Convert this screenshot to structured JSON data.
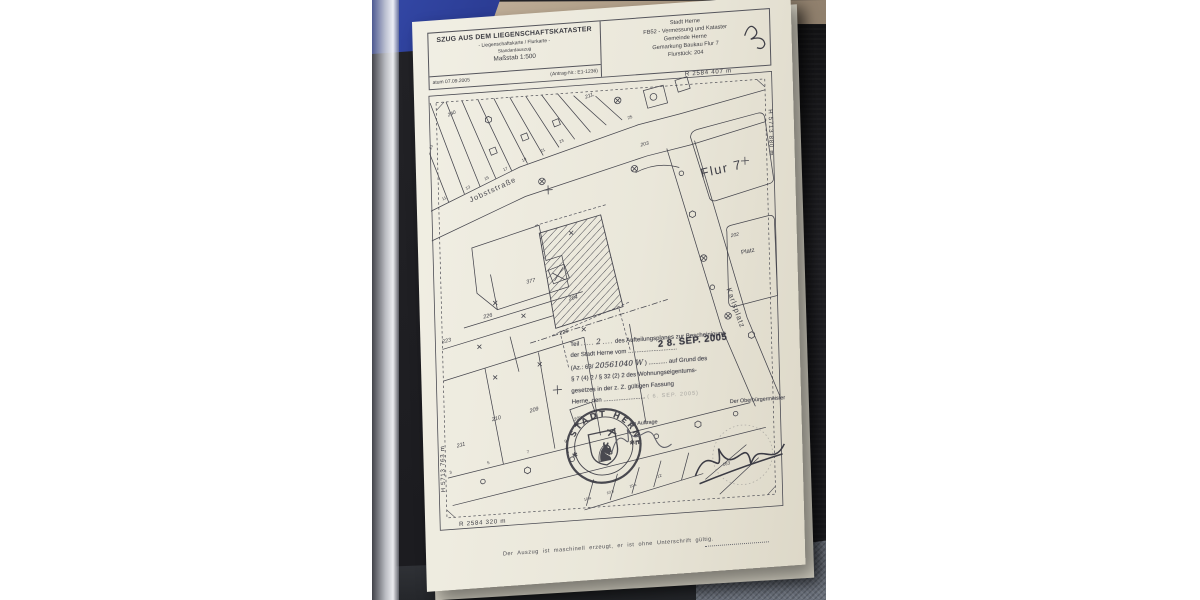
{
  "photo": {
    "colors": {
      "background": "#232327",
      "blue_fabric": "#2c3d95",
      "floor": "#ab9983",
      "carpet": "#6b717c",
      "paper": "#eae7da",
      "ink": "#3c3c42",
      "stamp_ink": "#45454e"
    }
  },
  "document": {
    "header": {
      "title": "SZUG AUS DEM LIEGENSCHAFTSKATASTER",
      "subtitle": "- Liegenschaftskarte / Flurkarte -",
      "subtitle2": "Standardauszug",
      "scale": "Maßstab 1:500",
      "date_line": "atum 07.09.2005",
      "request_no": "(Antrag-Nr.: E1-1236)",
      "office": [
        "Stadt Herne",
        "FB52 - Vermessung und Kataster",
        "Gemeinde Herne",
        "Gemarkung Baukau Flur 7",
        "Flurstück: 204"
      ],
      "handwritten_mark": "20"
    },
    "coordinates": {
      "top_right": "R 2584 407 m",
      "right": "H 5713 880 m",
      "left": "H 5713 763 m",
      "bottom_left": "R 2584 320 m"
    },
    "map_labels": [
      {
        "text": "240",
        "x": 20,
        "y": 34,
        "rot": -20,
        "size": 5,
        "cls": "it"
      },
      {
        "text": "211,",
        "x": 158,
        "y": 26,
        "rot": -18,
        "size": 5.2,
        "cls": "it"
      },
      {
        "text": "25",
        "x": 200,
        "y": 50,
        "rot": -18,
        "size": 4.4,
        "cls": ""
      },
      {
        "text": "23",
        "x": 2,
        "y": 66,
        "rot": -65,
        "size": 4,
        "cls": ""
      },
      {
        "text": "11",
        "x": 12,
        "y": 118,
        "rot": -22,
        "size": 4.2,
        "cls": ""
      },
      {
        "text": "13",
        "x": 36,
        "y": 109,
        "rot": -22,
        "size": 4.2,
        "cls": ""
      },
      {
        "text": "15",
        "x": 55,
        "y": 101,
        "rot": -22,
        "size": 4.2,
        "cls": ""
      },
      {
        "text": "17",
        "x": 74,
        "y": 93,
        "rot": -22,
        "size": 4.2,
        "cls": ""
      },
      {
        "text": "19",
        "x": 93,
        "y": 85,
        "rot": -22,
        "size": 4.2,
        "cls": ""
      },
      {
        "text": "21",
        "x": 112,
        "y": 77,
        "rot": -22,
        "size": 4.2,
        "cls": ""
      },
      {
        "text": "23",
        "x": 131,
        "y": 69,
        "rot": -22,
        "size": 4.2,
        "cls": ""
      },
      {
        "text": "Jobststraße",
        "x": 40,
        "y": 122,
        "rot": -21,
        "size": 7.5,
        "cls": "street"
      },
      {
        "text": "Flur 7",
        "x": 272,
        "y": 114,
        "rot": -9,
        "size": 13,
        "cls": "flur"
      },
      {
        "text": "203",
        "x": 212,
        "y": 78,
        "rot": -10,
        "size": 5,
        "cls": "it"
      },
      {
        "text": "202",
        "x": 300,
        "y": 176,
        "rot": -8,
        "size": 5,
        "cls": "it"
      },
      {
        "text": "Platz",
        "x": 310,
        "y": 194,
        "rot": -8,
        "size": 6.2,
        "cls": ""
      },
      {
        "text": "Karlsplatz",
        "x": 294,
        "y": 228,
        "rot": 72,
        "size": 7.5,
        "cls": "street"
      },
      {
        "text": "377",
        "x": 94,
        "y": 208,
        "rot": -10,
        "size": 5.5,
        "cls": "it"
      },
      {
        "text": "204",
        "x": 136,
        "y": 228,
        "rot": -10,
        "size": 5.5,
        "cls": "it"
      },
      {
        "text": "226",
        "x": 50,
        "y": 240,
        "rot": -10,
        "size": 5.5,
        "cls": "it"
      },
      {
        "text": "223",
        "x": 8,
        "y": 262,
        "rot": -10,
        "size": 5.5,
        "cls": "it"
      },
      {
        "text": "225",
        "x": 126,
        "y": 262,
        "rot": -13,
        "size": 5.5,
        "cls": "it"
      },
      {
        "text": "210",
        "x": 56,
        "y": 344,
        "rot": -12,
        "size": 5.5,
        "cls": "it"
      },
      {
        "text": "211",
        "x": 20,
        "y": 368,
        "rot": -12,
        "size": 5.5,
        "cls": "it"
      },
      {
        "text": "209",
        "x": 94,
        "y": 338,
        "rot": -12,
        "size": 5.5,
        "cls": "it"
      },
      {
        "text": "208",
        "x": 138,
        "y": 350,
        "rot": -12,
        "size": 5,
        "cls": "it"
      },
      {
        "text": "4",
        "x": 130,
        "y": 382,
        "rot": -12,
        "size": 4.2,
        "cls": ""
      },
      {
        "text": "3",
        "x": 12,
        "y": 394,
        "rot": -12,
        "size": 4.2,
        "cls": ""
      },
      {
        "text": "5",
        "x": 50,
        "y": 387,
        "rot": -12,
        "size": 4.2,
        "cls": ""
      },
      {
        "text": "7",
        "x": 90,
        "y": 379,
        "rot": -12,
        "size": 4.2,
        "cls": ""
      },
      {
        "text": "9",
        "x": 128,
        "y": 371,
        "rot": -12,
        "size": 4.2,
        "cls": ""
      },
      {
        "text": "10 a",
        "x": 146,
        "y": 431,
        "rot": -13,
        "size": 3.8,
        "cls": ""
      },
      {
        "text": "10 b",
        "x": 169,
        "y": 426,
        "rot": -13,
        "size": 3.8,
        "cls": ""
      },
      {
        "text": "10 c",
        "x": 192,
        "y": 421,
        "rot": -13,
        "size": 3.8,
        "cls": ""
      },
      {
        "text": "12",
        "x": 220,
        "y": 413,
        "rot": -13,
        "size": 4.2,
        "cls": ""
      },
      {
        "text": "163",
        "x": 286,
        "y": 406,
        "rot": -12,
        "size": 4.5,
        "cls": "it"
      },
      {
        "text": "R 2584 407 m",
        "x": 258,
        "y": 10,
        "rot": 0,
        "size": 6.2,
        "cls": "coord"
      },
      {
        "text": "H 5713 880 m",
        "x": 341,
        "y": 50,
        "rot": 90,
        "size": 6.2,
        "cls": "coord"
      },
      {
        "text": "H 5713 763 m",
        "x": 7,
        "y": 412,
        "rot": -90,
        "size": 6.2,
        "cls": "coord"
      },
      {
        "text": "R 2584 320 m",
        "x": 20,
        "y": 447,
        "rot": 0,
        "size": 6.2,
        "cls": "coord"
      }
    ],
    "stamp": {
      "line1_pre": "Teil",
      "line1_hw": "2",
      "line1_post": "des Aufteilungsplanes zur Bescheinigung",
      "line2": "der Stadt Herne vom .............................",
      "date_stamp": "2 8. SEP. 2005",
      "line3_pre": "(Az.: 63/",
      "az_handwritten": "20561040 W",
      "line3_post": ") ........... auf Grund des",
      "line4": "§ 7 (4) 2 / § 32 (2) 2 des Wohnungseigentums-",
      "line5": "gesetzes in der z. Z. gültigen Fassung",
      "line6": "Herne, den .........................",
      "date_stamp2": "( 6. SEP. 2005)",
      "signed_by": "Der Oberbürgermeister",
      "im_auftrage": "Im Auftrage",
      "seal_text": "STADT HERNE"
    },
    "footer": "Der Auszug ist maschinell erzeugt, er ist ohne Unterschrift gültig."
  }
}
